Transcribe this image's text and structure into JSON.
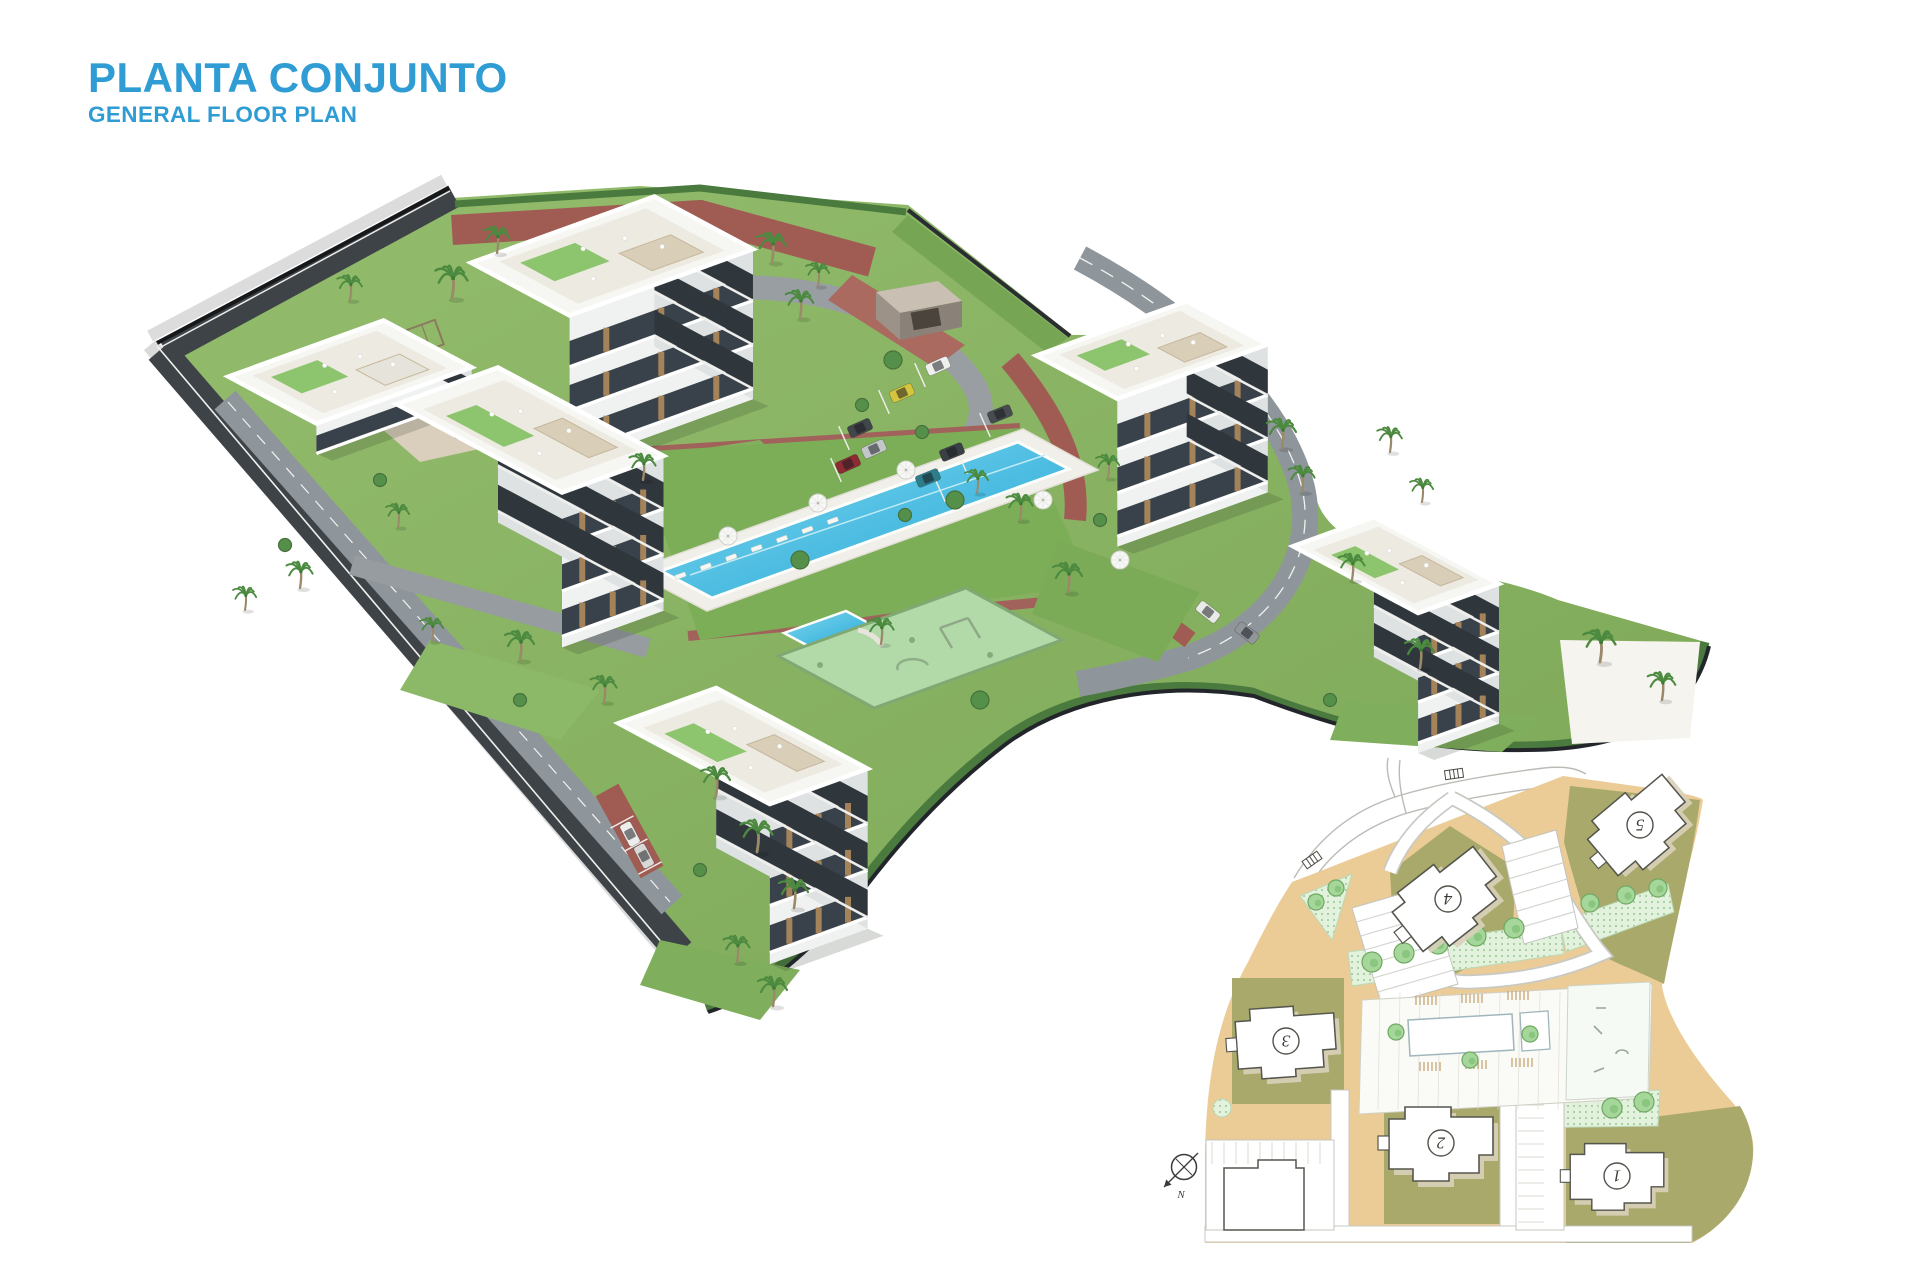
{
  "header": {
    "title": "PLANTA CONJUNTO",
    "subtitle": "GENERAL FLOOR PLAN",
    "accent_color": "#2F9CD4"
  },
  "site_plan": {
    "buildings": [
      {
        "label": "1"
      },
      {
        "label": "2"
      },
      {
        "label": "3"
      },
      {
        "label": "4"
      },
      {
        "label": "5"
      }
    ],
    "compass_label": "N"
  },
  "palette": {
    "accent_blue": "#2F9CD4",
    "pool_water": "#45BCE0",
    "lawn_green": "#84B160",
    "hedge_green": "#4A7A3E",
    "brick_path": "#A05B53",
    "asphalt": "#3E4348",
    "building_white": "#F4F5F2",
    "plan_ground_tan": "#EBCB96",
    "plan_plot_olive": "#A8A96A",
    "plan_garden_green": "#DDEFD8"
  }
}
